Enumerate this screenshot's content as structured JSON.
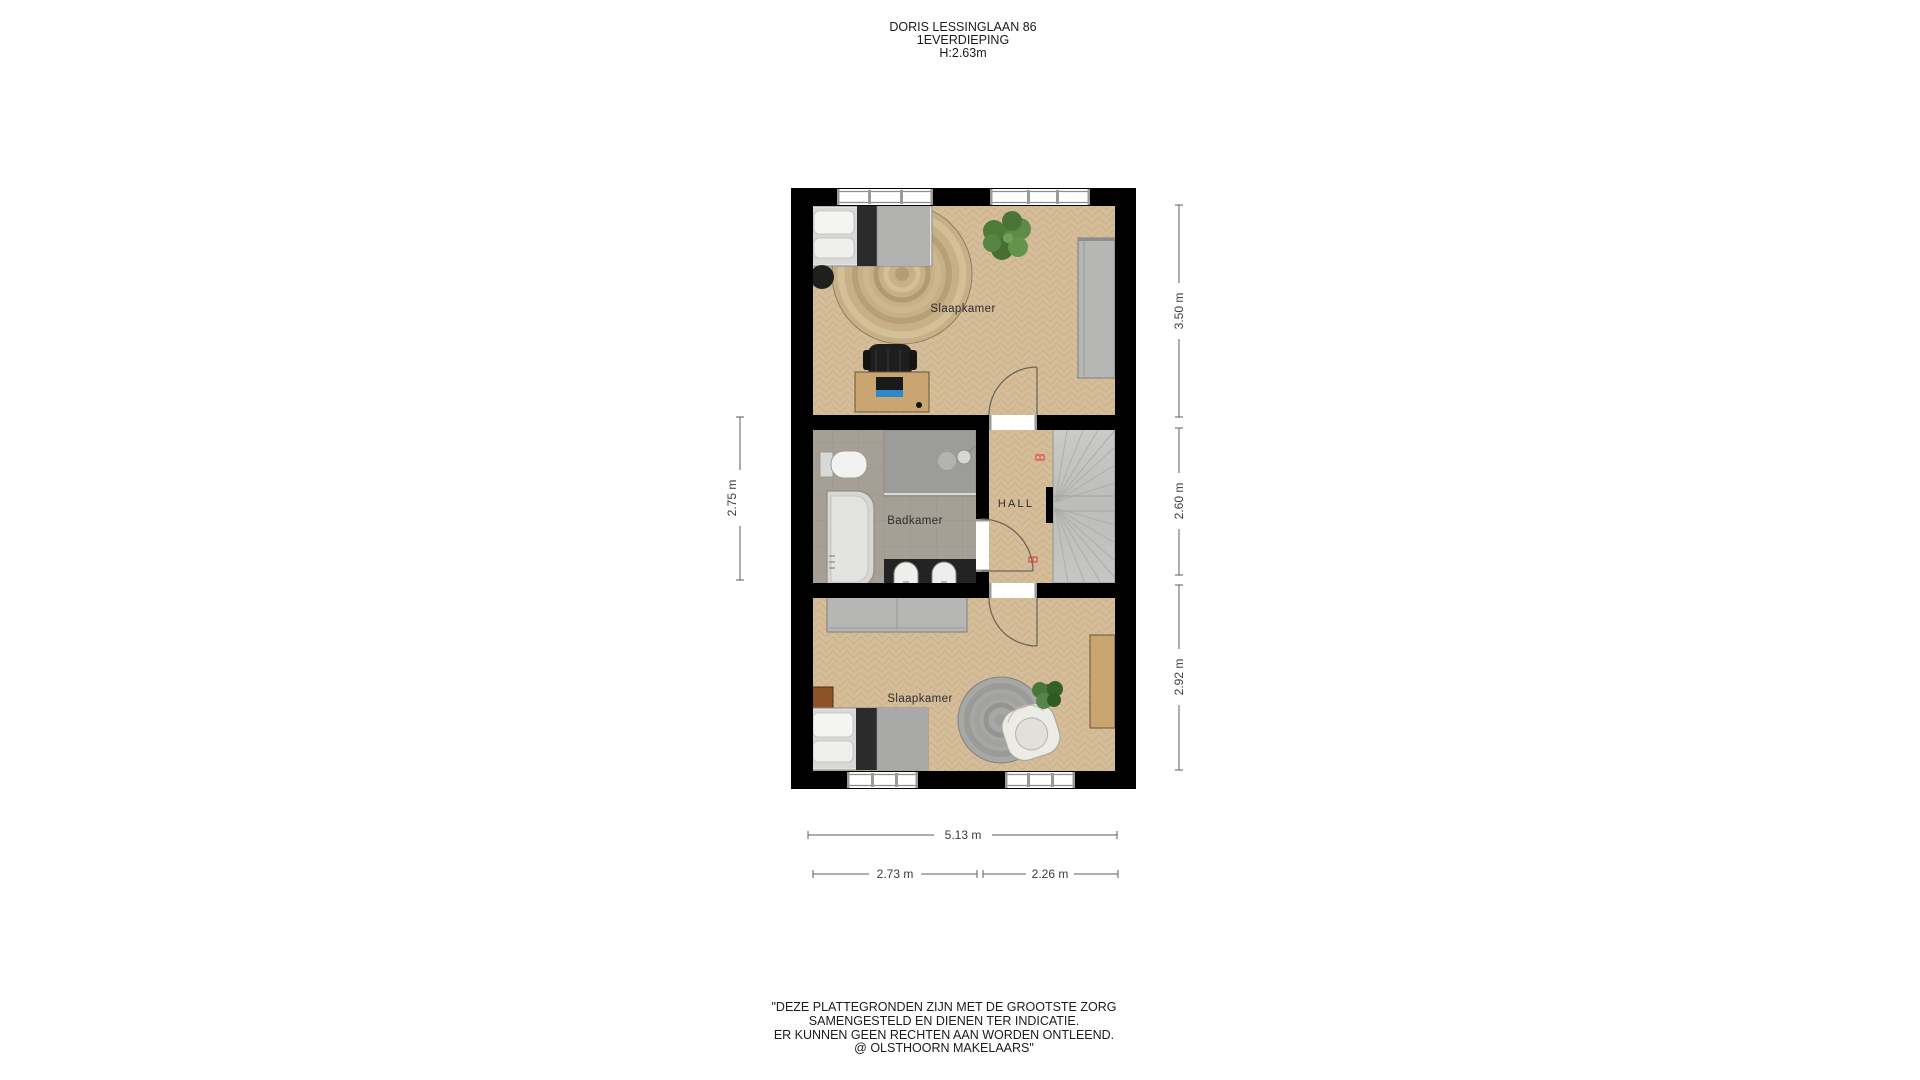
{
  "title": {
    "address": "DORIS LESSINGLAAN 86",
    "floor": "1EVERDIEPING",
    "ceiling_height": "H:2.63m"
  },
  "floorplan": {
    "labels": {
      "bedroom_top": "Slaapkamer",
      "bathroom": "Badkamer",
      "hall": "HALL",
      "bedroom_bottom": "Slaapkamer"
    },
    "dimensions": {
      "bedroom_top_height": "3.50 m",
      "hall_height": "2.60 m",
      "bedroom_bottom_height": "2.92 m",
      "bathroom_side": "2.75 m",
      "total_width": "5.13 m",
      "bottom_left_width": "2.73 m",
      "bottom_right_width": "2.26 m"
    },
    "colors": {
      "walls": "#000000",
      "wood_floor": "#d5bd9a",
      "bathroom_floor": "#a69f96",
      "shower_floor": "#9c9c9a",
      "rug_jute": "#c7b087",
      "rug_grey": "#a7a7a5",
      "marker_orange": "#d4755c",
      "dimension_text": "#3c3c3c"
    },
    "openings": {
      "windows": 4,
      "doors": 3
    },
    "furniture": {
      "bedroom_top": [
        "single-bed",
        "side-table",
        "round-jute-rug",
        "plant",
        "desk",
        "desk-chair",
        "laptop",
        "wardrobe"
      ],
      "bathroom": [
        "toilet",
        "walk-in-shower",
        "bathtub",
        "double-washbasin"
      ],
      "hall": [
        "winder-staircase",
        "radiator-marker",
        "radiator-marker"
      ],
      "bedroom_bottom": [
        "wardrobe",
        "nightstand",
        "single-bed",
        "round-rug",
        "armchair",
        "plant",
        "desk"
      ]
    }
  },
  "disclaimer": {
    "lines": [
      "\"DEZE PLATTEGRONDEN ZIJN MET DE GROOTSTE ZORG",
      "SAMENGESTELD EN DIENEN TER INDICATIE.",
      "ER KUNNEN GEEN RECHTEN AAN WORDEN ONTLEEND.",
      "@ OLSTHOORN MAKELAARS\""
    ]
  }
}
